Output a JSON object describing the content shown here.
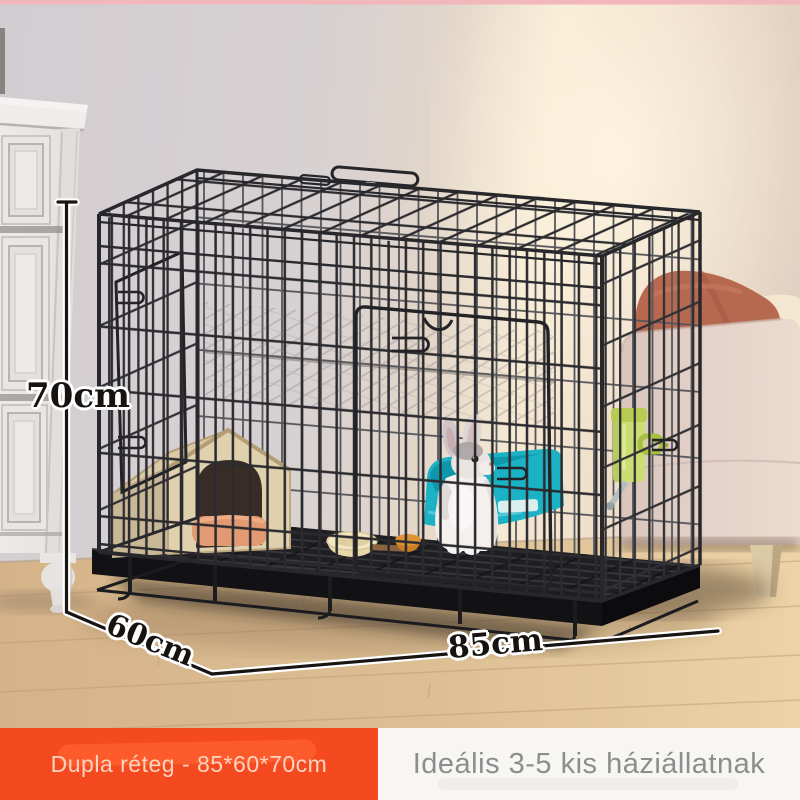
{
  "annotations": {
    "height_label": "70cm",
    "depth_label": "60cm",
    "width_label": "85cm"
  },
  "banner": {
    "left_text": "Dupla réteg - 85*60*70cm",
    "right_text": "Ideális 3-5 kis háziállatnak"
  },
  "colors": {
    "accent_orange": "#f54920",
    "banner_left_text": "#fbd4c0",
    "banner_right_bg": "#f8f6f2",
    "banner_right_text": "#8d8d8f",
    "cage_wire": "#2b2b2f",
    "litter_box_teal": "#1bb2c6",
    "water_bottle_green": "#cade74",
    "pillow_terracotta": "#b76950",
    "wood_floor": "#dcbd92",
    "dimension_line": "#171411"
  }
}
